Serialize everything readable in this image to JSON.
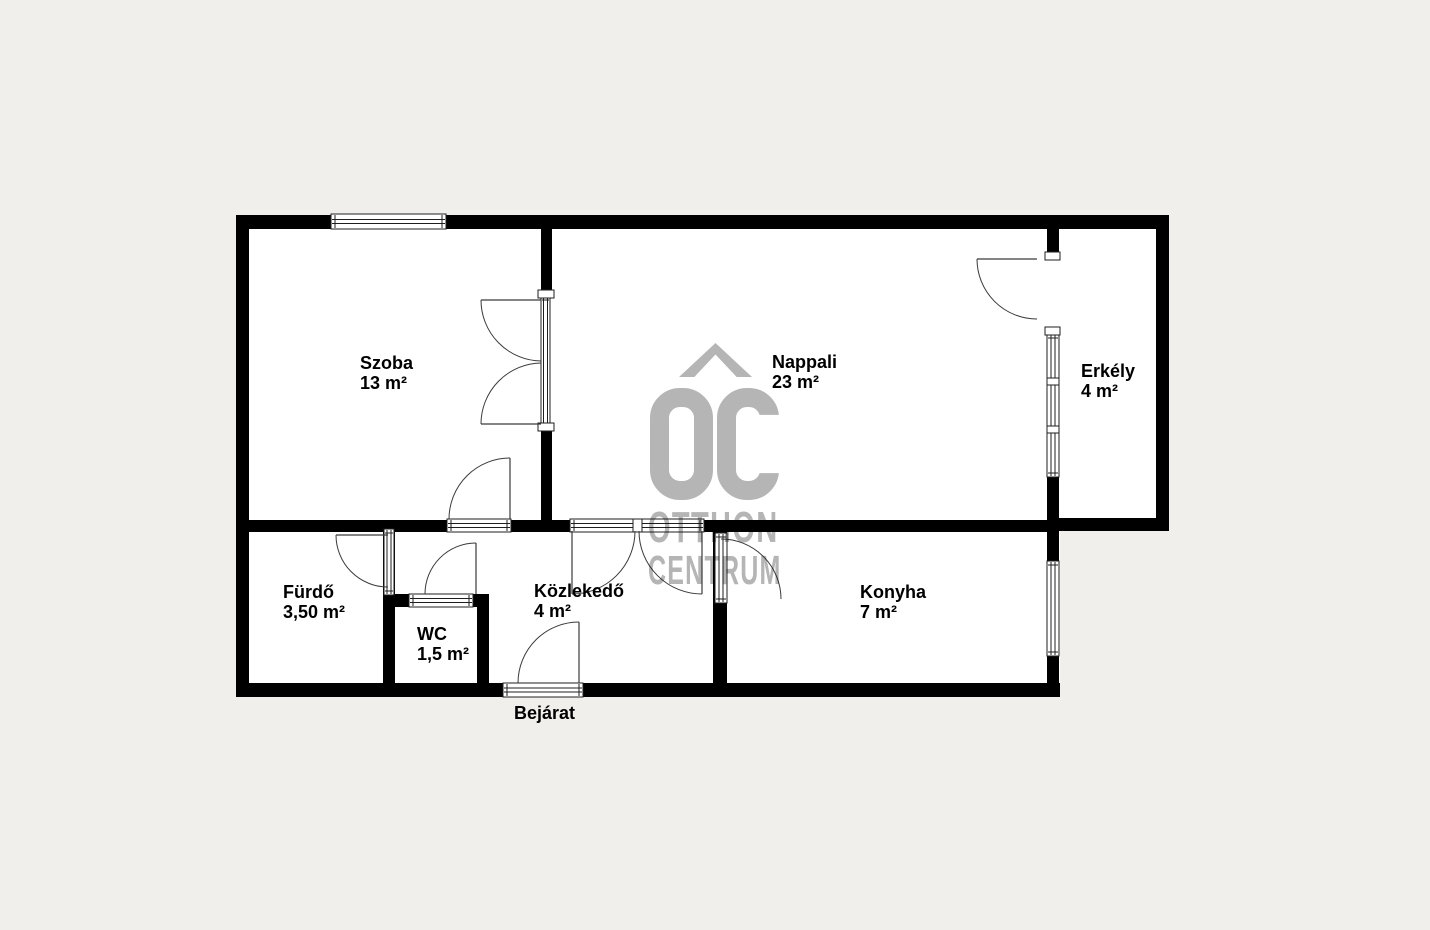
{
  "title": "Apartment floor plan",
  "background": "#f1efeb",
  "colors": {
    "floor": "#ffffff",
    "wall": "#000000",
    "line": "#1f1f1f",
    "door_line": "#3a3a3a",
    "watermark": "#b5b5b5",
    "text": "#000000"
  },
  "rooms": [
    {
      "name": "Szoba",
      "area": "13 m²",
      "x": 360,
      "y": 353
    },
    {
      "name": "Nappali",
      "area": "23 m²",
      "x": 772,
      "y": 352
    },
    {
      "name": "Erkély",
      "area": "4 m²",
      "x": 1081,
      "y": 361
    },
    {
      "name": "Fürdő",
      "area": "3,50 m²",
      "x": 283,
      "y": 582
    },
    {
      "name": "WC",
      "area": "1,5 m²",
      "x": 417,
      "y": 624
    },
    {
      "name": "Közlekedő",
      "area": "4 m²",
      "x": 534,
      "y": 581
    },
    {
      "name": "Konyha",
      "area": "7 m²",
      "x": 860,
      "y": 582
    }
  ],
  "entrance_label": "Bejárat",
  "watermark": {
    "monogram": "OC",
    "line1": "OTTHON",
    "line2": "CENTRUM"
  },
  "plan": {
    "floors": [
      [
        236,
        215,
        824,
        482
      ],
      [
        1047,
        229,
        110,
        290
      ]
    ],
    "walls": [
      [
        236,
        215,
        933,
        14
      ],
      [
        236,
        215,
        13,
        482
      ],
      [
        236,
        683,
        824,
        14
      ],
      [
        236,
        520,
        823,
        12
      ],
      [
        541,
        229,
        11,
        66
      ],
      [
        541,
        429,
        11,
        91
      ],
      [
        1156,
        215,
        13,
        316
      ],
      [
        1047,
        518,
        122,
        13
      ],
      [
        1047,
        215,
        12,
        41
      ],
      [
        1047,
        476,
        12,
        55
      ],
      [
        383,
        530,
        12,
        153
      ],
      [
        383,
        594,
        106,
        13
      ],
      [
        477,
        594,
        12,
        89
      ],
      [
        713,
        520,
        14,
        163
      ],
      [
        1047,
        520,
        12,
        177
      ]
    ],
    "openings": [
      {
        "x": 331,
        "y": 214,
        "w": 115,
        "h": 15,
        "o": "h",
        "kind": "window"
      },
      {
        "x": 447,
        "y": 519,
        "w": 64,
        "h": 13,
        "o": "h",
        "kind": "door-threshold"
      },
      {
        "x": 570,
        "y": 519,
        "w": 134,
        "h": 13,
        "o": "h",
        "kind": "double-door-threshold"
      },
      {
        "x": 409,
        "y": 594,
        "w": 64,
        "h": 13,
        "o": "h",
        "kind": "door-threshold"
      },
      {
        "x": 503,
        "y": 683,
        "w": 80,
        "h": 14,
        "o": "h",
        "kind": "entrance-threshold"
      },
      {
        "x": 384,
        "y": 529,
        "w": 10,
        "h": 66,
        "o": "v",
        "kind": "glazed-door"
      },
      {
        "x": 715,
        "y": 533,
        "w": 12,
        "h": 70,
        "o": "v",
        "kind": "glazed-door"
      },
      {
        "x": 541,
        "y": 296,
        "w": 9,
        "h": 131,
        "o": "v",
        "kind": "glazed-double-door"
      },
      {
        "x": 1047,
        "y": 334,
        "w": 12,
        "h": 143,
        "o": "v",
        "kind": "window"
      },
      {
        "x": 1047,
        "y": 561,
        "w": 12,
        "h": 95,
        "o": "v",
        "kind": "window"
      }
    ],
    "caps": [
      [
        538,
        290,
        16,
        8
      ],
      [
        538,
        423,
        16,
        8
      ],
      [
        1045,
        252,
        15,
        8
      ],
      [
        1045,
        327,
        15,
        8
      ],
      [
        1047,
        378,
        12,
        7
      ],
      [
        1047,
        426,
        12,
        7
      ],
      [
        633,
        519,
        9,
        13
      ]
    ],
    "doors": [
      {
        "leaf": [
          541,
          300,
          481,
          300
        ],
        "arc": "M481,300A61,61 0 0 0 541,361"
      },
      {
        "leaf": [
          541,
          424,
          481,
          424
        ],
        "arc": "M481,424A61,61 0 0 1 541,363"
      },
      {
        "leaf": [
          510,
          519,
          510,
          458
        ],
        "arc": "M449,519A61,61 0 0 1 510,458"
      },
      {
        "leaf": [
          476,
          594,
          476,
          543
        ],
        "arc": "M425,594A51,51 0 0 1 476,543"
      },
      {
        "leaf": [
          579,
          683,
          579,
          622
        ],
        "arc": "M518,683A61,61 0 0 1 579,622"
      },
      {
        "leaf": [
          388,
          535,
          336,
          535
        ],
        "arc": "M336,535A52,52 0 0 0 388,587"
      },
      {
        "arc": "M721,539A60,60 0 0 1 781,599"
      },
      {
        "leaf": [
          1037,
          259,
          977,
          259
        ],
        "arc": "M977,259A60,60 0 0 0 1037,319"
      },
      {
        "leaf": [
          572,
          531,
          572,
          594
        ],
        "arc": "M572,594A63,63 0 0 0 635,531"
      },
      {
        "leaf": [
          702,
          531,
          702,
          594
        ],
        "arc": "M702,594A63,63 0 0 1 639,531"
      }
    ]
  }
}
